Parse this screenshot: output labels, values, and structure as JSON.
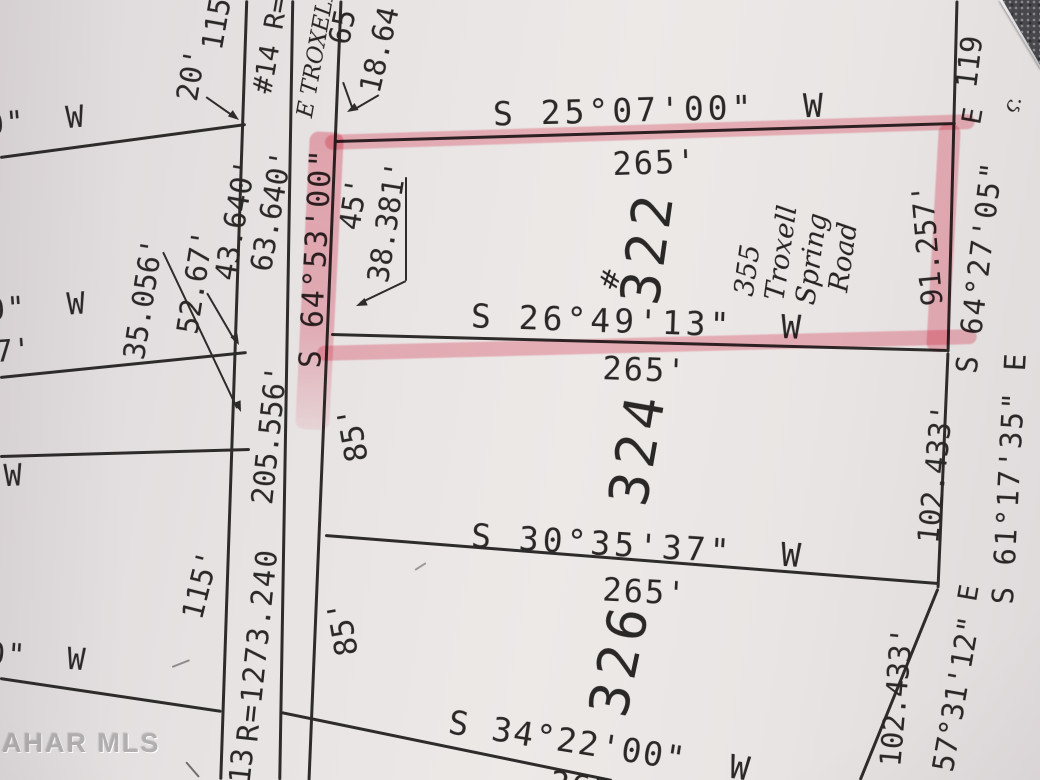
{
  "photo": {
    "watermark": "AHAR MLS",
    "paper_color": "#e9e5e4",
    "ink_color": "#2e2b2b",
    "highlight_color": "#ed5a73",
    "highlighted_lot": "322",
    "handwritten_address": "355 Troxell Spring Road",
    "handwritten_street": "E TROXELL"
  },
  "plat": {
    "lines": [
      {
        "name": "road-left-edge",
        "x1": 247,
        "y1": 0,
        "x2": 221,
        "y2": 780,
        "w": 2.5
      },
      {
        "name": "road-right-edge",
        "x1": 293,
        "y1": 0,
        "x2": 280,
        "y2": 780,
        "w": 2.5
      },
      {
        "name": "lot-frontage-line",
        "x1": 341,
        "y1": 0,
        "x2": 309,
        "y2": 780,
        "w": 3
      },
      {
        "name": "east-boundary-lot322",
        "x1": 957,
        "y1": 0,
        "x2": 948,
        "y2": 352,
        "w": 3
      },
      {
        "name": "east-boundary-lot324",
        "x1": 948,
        "y1": 352,
        "x2": 938,
        "y2": 588,
        "w": 3
      },
      {
        "name": "east-boundary-lot326",
        "x1": 938,
        "y1": 588,
        "x2": 860,
        "y2": 780,
        "w": 3
      },
      {
        "name": "west-block-line-1",
        "x1": 0,
        "y1": 157,
        "x2": 246,
        "y2": 124,
        "w": 2.5
      },
      {
        "name": "west-block-line-2",
        "x1": 0,
        "y1": 377,
        "x2": 247,
        "y2": 352,
        "w": 2.5
      },
      {
        "name": "west-block-line-3",
        "x1": 0,
        "y1": 456,
        "x2": 250,
        "y2": 449,
        "w": 2.5
      },
      {
        "name": "west-block-line-4",
        "x1": 0,
        "y1": 678,
        "x2": 222,
        "y2": 711,
        "w": 2.5
      },
      {
        "name": "lot326-south-line",
        "x1": 281,
        "y1": 712,
        "x2": 612,
        "y2": 780,
        "w": 3
      },
      {
        "name": "lot322-north-line",
        "x1": 335,
        "y1": 141,
        "x2": 956,
        "y2": 123,
        "w": 3
      },
      {
        "name": "lot322-south-line",
        "x1": 331,
        "y1": 334,
        "x2": 948,
        "y2": 350,
        "w": 3
      },
      {
        "name": "lot324-south-line",
        "x1": 325,
        "y1": 535,
        "x2": 938,
        "y2": 583,
        "w": 3
      },
      {
        "name": "leader-20ft",
        "x1": 206,
        "y1": 97,
        "x2": 236,
        "y2": 118,
        "w": 2
      },
      {
        "name": "leader-35056",
        "x1": 163,
        "y1": 252,
        "x2": 237,
        "y2": 408,
        "w": 2
      },
      {
        "name": "leader-5267",
        "x1": 207,
        "y1": 293,
        "x2": 235,
        "y2": 341,
        "w": 2
      },
      {
        "name": "leader-38381-a",
        "x1": 406,
        "y1": 177,
        "x2": 406,
        "y2": 281,
        "w": 2
      },
      {
        "name": "leader-38381-b",
        "x1": 406,
        "y1": 281,
        "x2": 360,
        "y2": 303,
        "w": 2
      },
      {
        "name": "leader-65-a",
        "x1": 343,
        "y1": 82,
        "x2": 352,
        "y2": 107,
        "w": 2
      },
      {
        "name": "leader-65-b",
        "x1": 379,
        "y1": 95,
        "x2": 355,
        "y2": 109,
        "w": 2
      }
    ],
    "arrows": [
      {
        "name": "arrowhead-20ft",
        "x": 239,
        "y": 120,
        "dir": 38
      },
      {
        "name": "arrowhead-35056",
        "x": 241,
        "y": 412,
        "dir": 68
      },
      {
        "name": "arrowhead-5267",
        "x": 239,
        "y": 345,
        "dir": 62
      },
      {
        "name": "arrowhead-38381",
        "x": 356,
        "y": 306,
        "dir": 157
      },
      {
        "name": "arrowhead-65",
        "x": 347,
        "y": 112,
        "dir": 150
      }
    ],
    "labels": [
      {
        "name": "bearing-lot322-north",
        "text": "S 25°07'00\"  W",
        "x": 660,
        "y": 110,
        "rot": -1.5,
        "fs": 33,
        "ls": 4
      },
      {
        "name": "distance-lot322-north",
        "text": "265'",
        "x": 655,
        "y": 163,
        "rot": -2,
        "fs": 32,
        "ls": 2
      },
      {
        "name": "bearing-lot322-south",
        "text": "S 26°49'13\"  W",
        "x": 638,
        "y": 322,
        "rot": 2,
        "fs": 33,
        "ls": 4
      },
      {
        "name": "distance-lot324-north",
        "text": "265'",
        "x": 645,
        "y": 370,
        "rot": 2,
        "fs": 32,
        "ls": 2
      },
      {
        "name": "bearing-lot324-south",
        "text": "S 30°35'37\"  W",
        "x": 638,
        "y": 546,
        "rot": 3.5,
        "fs": 33,
        "ls": 4
      },
      {
        "name": "distance-lot326-north",
        "text": "265'",
        "x": 645,
        "y": 592,
        "rot": 3,
        "fs": 32,
        "ls": 2
      },
      {
        "name": "bearing-lot326-south",
        "text": "S 34°22'00\"  W",
        "x": 600,
        "y": 746,
        "rot": 9,
        "fs": 33,
        "ls": 2
      },
      {
        "name": "distance-lot326-south-cut",
        "text": "265'",
        "x": 592,
        "y": 789,
        "rot": 9,
        "fs": 32,
        "ls": 2
      },
      {
        "name": "bearing-west-1",
        "text": "0\"  W",
        "x": 36,
        "y": 122,
        "rot": -5,
        "fs": 30,
        "ls": 2
      },
      {
        "name": "bearing-west-2",
        "text": "0\"  W",
        "x": 37,
        "y": 308,
        "rot": -4,
        "fs": 30,
        "ls": 2
      },
      {
        "name": "distance-west-7",
        "text": "7'",
        "x": 13,
        "y": 352,
        "rot": -4,
        "fs": 30
      },
      {
        "name": "bearing-west-w",
        "text": "W",
        "x": 13,
        "y": 477,
        "rot": -3,
        "fs": 30
      },
      {
        "name": "bearing-west-3",
        "text": "0\"  W",
        "x": 37,
        "y": 658,
        "rot": 4,
        "fs": 30,
        "ls": 2
      },
      {
        "name": "distance-115-top",
        "text": "115",
        "x": 217,
        "y": 24,
        "rot": -80,
        "fs": 29
      },
      {
        "name": "distance-20ft",
        "text": "20'",
        "x": 192,
        "y": 75,
        "rot": -80,
        "fs": 29
      },
      {
        "name": "road-curve-14",
        "text": "#14 R=",
        "x": 271,
        "y": 45,
        "rot": -80,
        "fs": 27
      },
      {
        "name": "distance-65",
        "text": "65",
        "x": 343,
        "y": 27,
        "rot": -78,
        "fs": 29
      },
      {
        "name": "distance-1864",
        "text": "18.64",
        "x": 380,
        "y": 50,
        "rot": -77,
        "fs": 29
      },
      {
        "name": "distance-43640",
        "text": "43.640'",
        "x": 236,
        "y": 220,
        "rot": -80,
        "fs": 29
      },
      {
        "name": "distance-63640",
        "text": "63.640'",
        "x": 272,
        "y": 211,
        "rot": -80,
        "fs": 29
      },
      {
        "name": "distance-35056",
        "text": "35.056'",
        "x": 144,
        "y": 299,
        "rot": -81,
        "fs": 29
      },
      {
        "name": "distance-5267",
        "text": "52.67'",
        "x": 196,
        "y": 282,
        "rot": -81,
        "fs": 29
      },
      {
        "name": "bearing-road",
        "text": "S 64°53'00\"",
        "x": 317,
        "y": 258,
        "rot": -87,
        "fs": 30,
        "ls": 2
      },
      {
        "name": "distance-road-205556",
        "text": "205.556'",
        "x": 270,
        "y": 435,
        "rot": -84,
        "fs": 29
      },
      {
        "name": "road-curve-13-radius",
        "text": "R=1273.240",
        "x": 258,
        "y": 645,
        "rot": -84,
        "fs": 29,
        "ls": 2
      },
      {
        "name": "road-curve-13",
        "text": "13",
        "x": 242,
        "y": 766,
        "rot": -84,
        "fs": 29
      },
      {
        "name": "distance-115-left",
        "text": "115'",
        "x": 201,
        "y": 585,
        "rot": -76,
        "fs": 29
      },
      {
        "name": "distance-85-lot324",
        "text": "85'",
        "x": 354,
        "y": 434,
        "rot": -100,
        "fs": 31
      },
      {
        "name": "distance-85-lot326",
        "text": "85'",
        "x": 344,
        "y": 628,
        "rot": -100,
        "fs": 31
      },
      {
        "name": "distance-45",
        "text": "45'",
        "x": 354,
        "y": 204,
        "rot": -81,
        "fs": 29
      },
      {
        "name": "distance-38381",
        "text": "38.381'",
        "x": 388,
        "y": 222,
        "rot": -81,
        "fs": 29
      },
      {
        "name": "lot-number-322",
        "text": "322",
        "x": 648,
        "y": 247,
        "rot": -82,
        "fs": 54,
        "ls": 6
      },
      {
        "name": "lot-number-324",
        "text": "324",
        "x": 638,
        "y": 448,
        "rot": -80,
        "fs": 54,
        "ls": 6
      },
      {
        "name": "lot-number-326",
        "text": "326",
        "x": 620,
        "y": 659,
        "rot": -78,
        "fs": 54,
        "ls": 6
      },
      {
        "name": "distance-91257",
        "text": "91.257'",
        "x": 928,
        "y": 245,
        "rot": -95,
        "fs": 29
      },
      {
        "name": "distance-119",
        "text": "119",
        "x": 970,
        "y": 62,
        "rot": -83,
        "fs": 29
      },
      {
        "name": "bearing-lot322-east",
        "text": "S 64°27'05\"",
        "x": 980,
        "y": 267,
        "rot": -83,
        "fs": 29,
        "ls": 2
      },
      {
        "name": "bearing-lot322-east-e",
        "text": "E",
        "x": 973,
        "y": 116,
        "rot": -80,
        "fs": 27
      },
      {
        "name": "distance-102433-lot324",
        "text": "102.433'",
        "x": 936,
        "y": 474,
        "rot": -84,
        "fs": 29
      },
      {
        "name": "bearing-lot324-east",
        "text": "S 61°17'35\" E",
        "x": 1010,
        "y": 478,
        "rot": -87,
        "fs": 29,
        "ls": 2
      },
      {
        "name": "bearing-lot326-east-e",
        "text": "E",
        "x": 969,
        "y": 593,
        "rot": -80,
        "fs": 27
      },
      {
        "name": "bearing-lot326-east",
        "text": "57°31'12\"",
        "x": 957,
        "y": 694,
        "rot": -80,
        "fs": 29
      },
      {
        "name": "distance-102433-lot326",
        "text": "102.433'",
        "x": 897,
        "y": 697,
        "rot": -85,
        "fs": 29
      },
      {
        "name": "handwritten-street-name",
        "text": "E TROXELL",
        "x": 317,
        "y": 52,
        "rot": -80,
        "fs": 22,
        "f": "hand"
      },
      {
        "name": "handwritten-address",
        "text": "355\nTroxell\nSpring\n  Road",
        "x": 797,
        "y": 255,
        "rot": -82,
        "fs": 27,
        "f": "hand",
        "lh": 1.15
      },
      {
        "name": "handwritten-hash-mark",
        "text": "#",
        "x": 612,
        "y": 280,
        "rot": -70,
        "fs": 26,
        "f": "hand"
      },
      {
        "name": "handwritten-check-mark",
        "text": "ς.",
        "x": 1012,
        "y": 103,
        "rot": -55,
        "fs": 20,
        "f": "hand"
      }
    ],
    "highlights": [
      {
        "name": "highlight-lot322-north",
        "x1": 325,
        "y1": 142,
        "x2": 975,
        "y2": 121,
        "w": 15
      },
      {
        "name": "highlight-lot322-west",
        "x1": 327,
        "y1": 132,
        "x2": 312,
        "y2": 430,
        "w": 34,
        "fade": true
      },
      {
        "name": "highlight-lot322-south",
        "x1": 317,
        "y1": 353,
        "x2": 977,
        "y2": 336,
        "w": 15
      },
      {
        "name": "highlight-lot322-east",
        "x1": 950,
        "y1": 124,
        "x2": 937,
        "y2": 352,
        "w": 22
      }
    ],
    "marks": [
      {
        "name": "stray-pencil-mark-1",
        "x1": 172,
        "y1": 667,
        "x2": 190,
        "y2": 660,
        "w": 2,
        "color": "#8f8d8e"
      },
      {
        "name": "stray-pencil-mark-2",
        "x1": 186,
        "y1": 762,
        "x2": 199,
        "y2": 777,
        "w": 2,
        "color": "#6f6d6e"
      },
      {
        "name": "stray-pencil-mark-3",
        "x1": 415,
        "y1": 570,
        "x2": 426,
        "y2": 563,
        "w": 2,
        "color": "#9a9898"
      }
    ]
  }
}
